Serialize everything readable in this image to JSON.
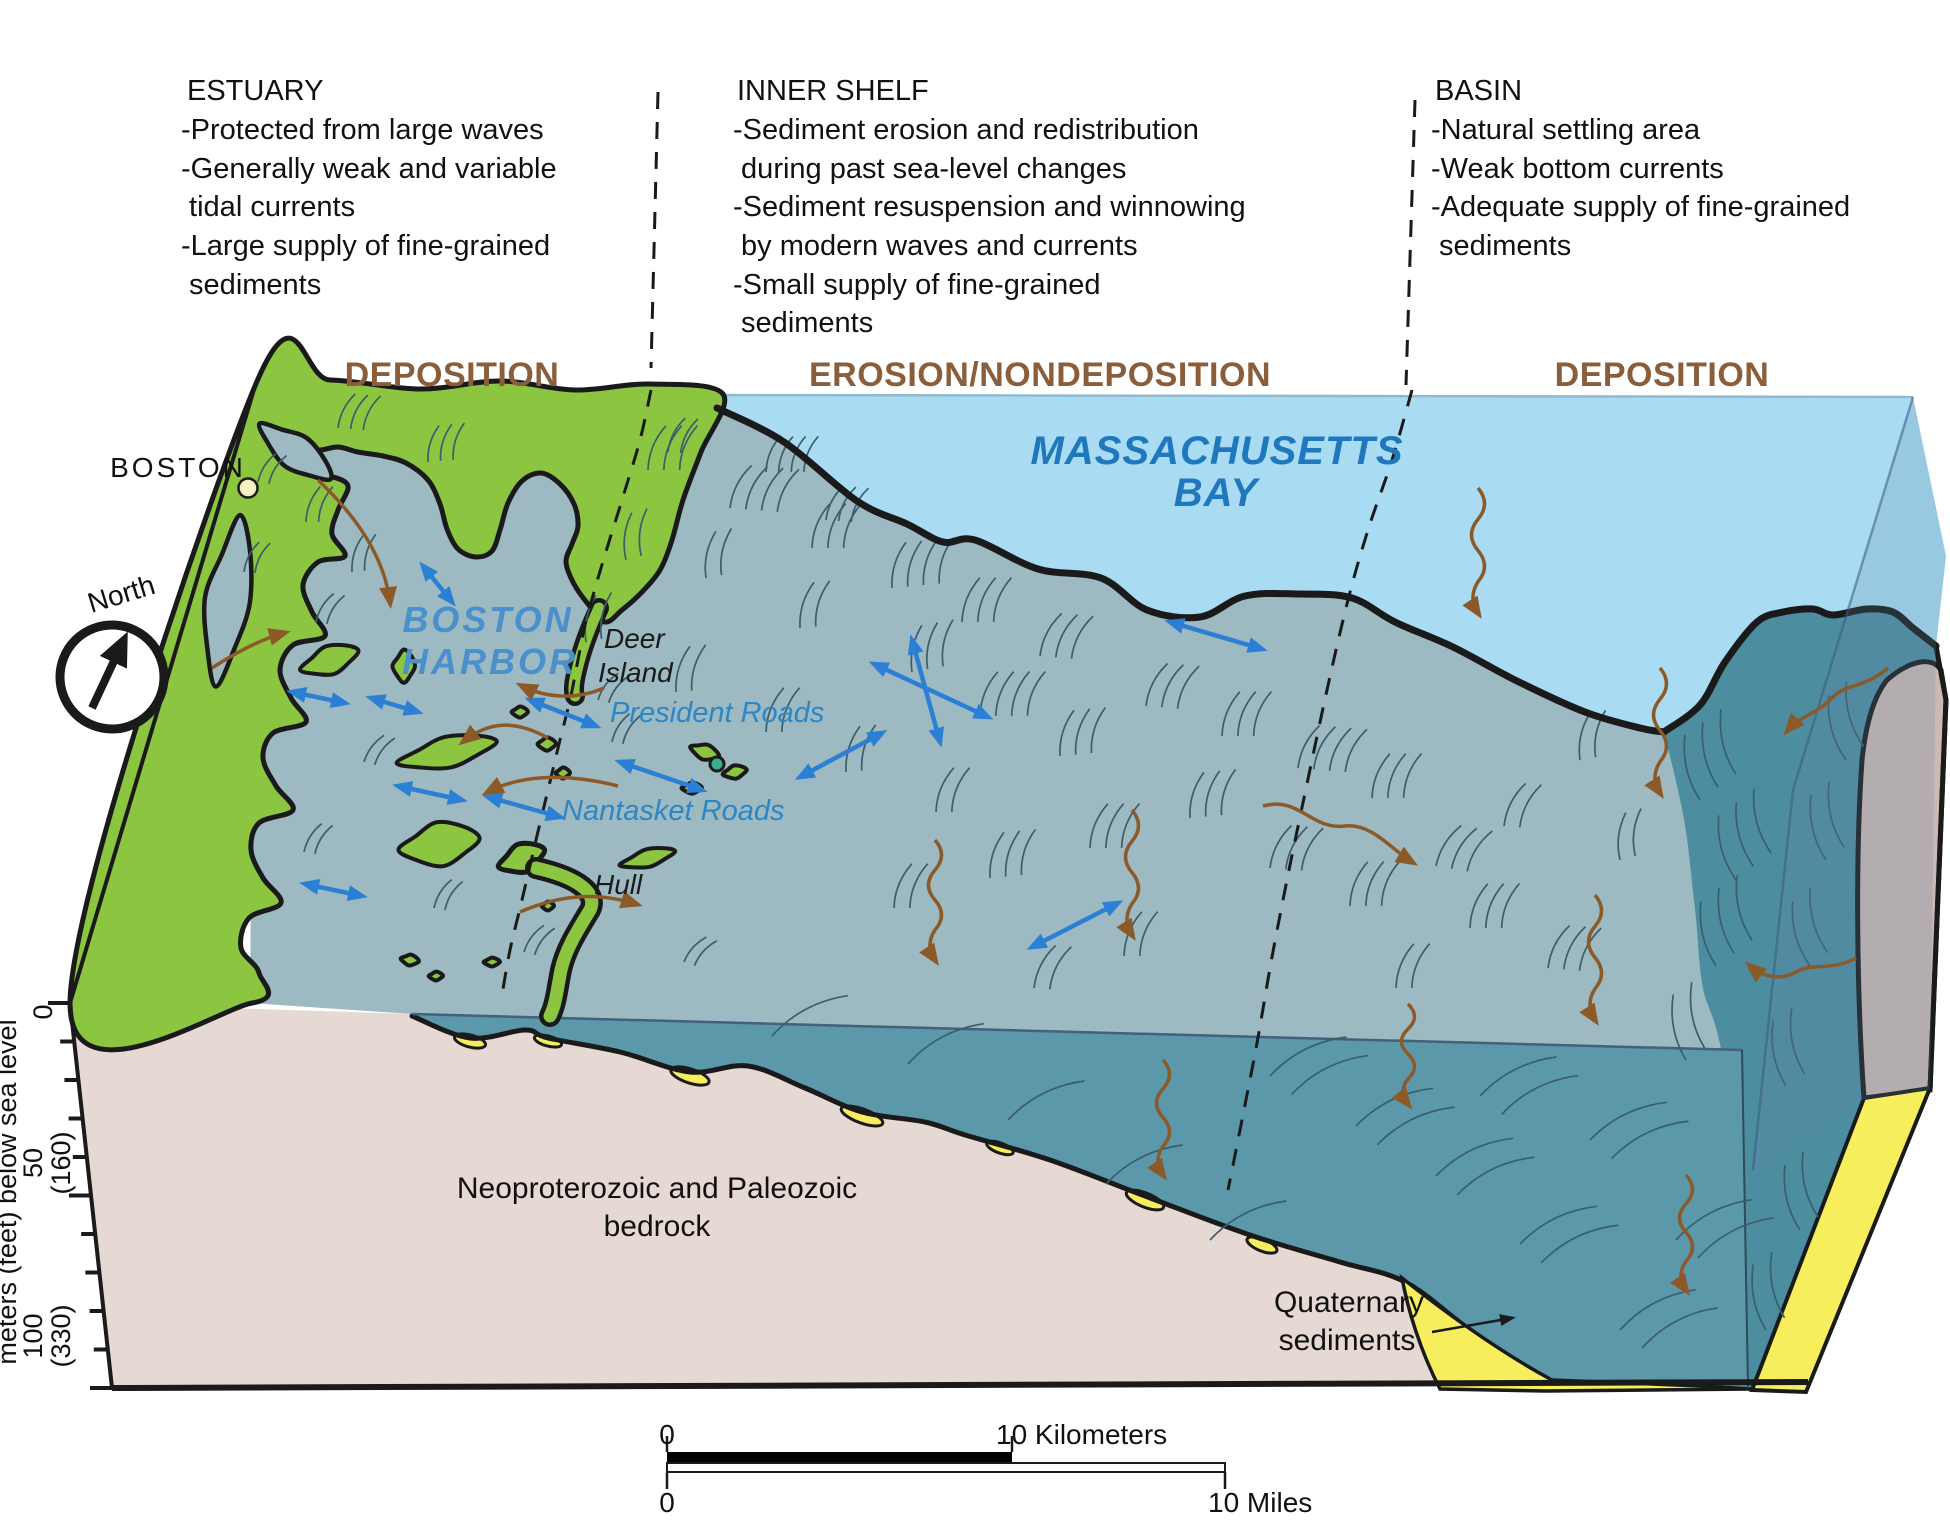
{
  "annotation_columns": [
    {
      "title": "ESTUARY",
      "lines": [
        "-Protected from large waves",
        "-Generally weak and variable",
        " tidal currents",
        "-Large supply of fine-grained",
        " sediments"
      ]
    },
    {
      "title": "INNER SHELF",
      "lines": [
        "-Sediment erosion and redistribution",
        " during past sea-level changes",
        "-Sediment resuspension and winnowing",
        " by modern waves and currents",
        "-Small supply of fine-grained",
        " sediments"
      ]
    },
    {
      "title": "BASIN",
      "lines": [
        "-Natural settling area",
        "-Weak bottom currents",
        "-Adequate supply of fine-grained",
        " sediments"
      ]
    }
  ],
  "zone_labels": [
    "DEPOSITION",
    "EROSION/NONDEPOSITION",
    "DEPOSITION"
  ],
  "map": {
    "city": "BOSTON",
    "north": "North",
    "harbor_line1": "BOSTON",
    "harbor_line2": "HARBOR",
    "bay_line1": "MASSACHUSETTS",
    "bay_line2": "BAY",
    "deer_line1": "Deer",
    "deer_line2": "Island",
    "president_roads": "President Roads",
    "nantasket_roads": "Nantasket Roads",
    "hull": "Hull"
  },
  "cross_section": {
    "bedrock_line1": "Neoproterozoic and Paleozoic",
    "bedrock_line2": "bedrock",
    "quaternary_line1": "Quaternary",
    "quaternary_line2": "sediments"
  },
  "axis": {
    "title": "meters (feet) below sea level",
    "tick_0": "0",
    "tick_50": "50",
    "tick_50_ft": "(160)",
    "tick_100": "100",
    "tick_100_ft": "(330)"
  },
  "scale_bar": {
    "km_zero": "0",
    "km_label": "10 Kilometers",
    "mi_zero": "0",
    "mi_label": "10 Miles"
  },
  "icons": {
    "compass": "north-arrow-icon",
    "tidal_current": "double-headed-arrow-icon",
    "sediment_transport": "squiggly-arrow-icon",
    "city_marker": "location-dot-icon"
  },
  "colors": {
    "land_green": "#8CC640",
    "seafloor_gray_blue": "#9DB9C1",
    "bay_light_blue": "#A9DCF3",
    "water_teal": "#5B99AA",
    "bank_teal": "#4C8DA0",
    "bedrock_pink": "#E6D8D3",
    "outcrop_gray": "#CBB9B4",
    "quaternary_yellow": "#F6EE5C",
    "outline_black": "#1A1A1A",
    "lineation": "#3B5E6B",
    "current_arrow_blue": "#2B7FD4",
    "transport_arrow_brown": "#8B5A28",
    "zone_label_brown": "#8B5E3B",
    "water_text_blue": "#1F78BD"
  }
}
